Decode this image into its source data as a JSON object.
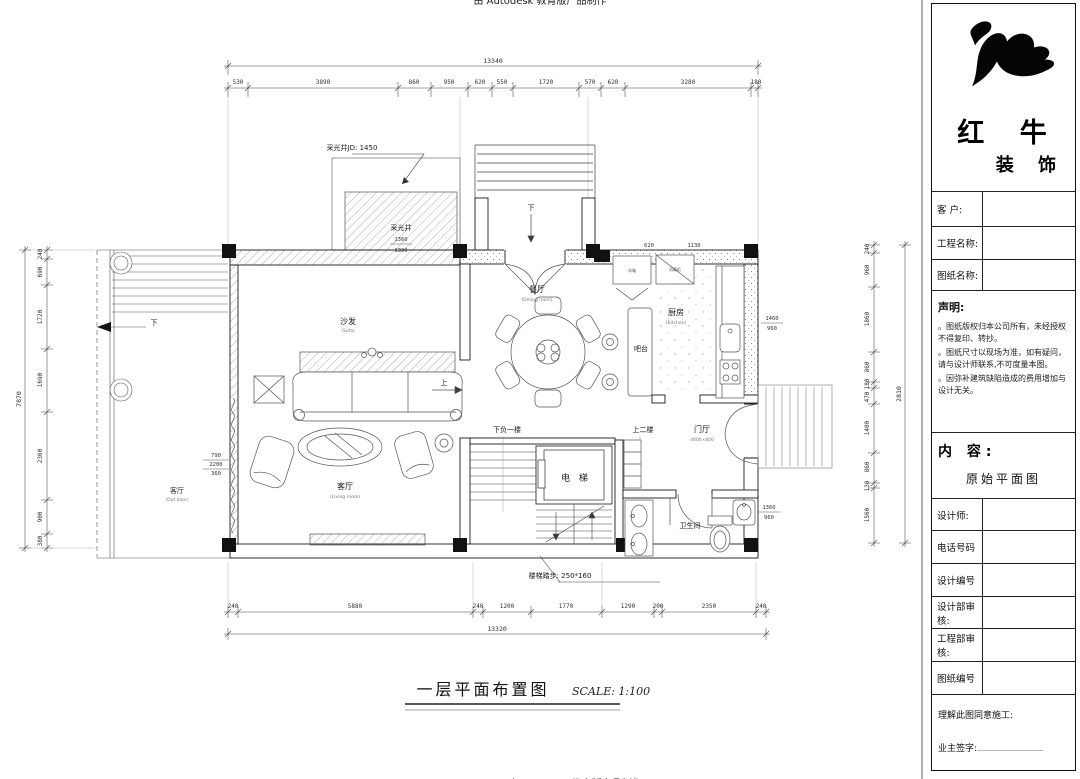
{
  "watermark": {
    "top": "由 Autodesk 教育版产品制作",
    "bottom": "由 Autodesk 教育版产品制作"
  },
  "title_block": {
    "brand_line1": "红 牛",
    "brand_line2": "装 饰",
    "row_customer": "客  户:",
    "row_project": "工程名称:",
    "row_drawing": "图纸名称:",
    "statement_title": "声明:",
    "statement_item1": "。图纸版权归本公司所有，未经授权不得复印、转抄。",
    "statement_item2": "。图纸尺寸以现场为准，如有疑问，请与设计师联系,不可度量本图。",
    "statement_item3": "。因弥补建筑缺陷造成的费用增加与设计无关。",
    "content_label": "内 容:",
    "content_value": "原始平面图",
    "row_designer": "设计师:",
    "row_phone": "电话号码",
    "row_design_no": "设计编号",
    "row_design_audit": "设计部审核:",
    "row_eng_audit": "工程部审核:",
    "row_drawing_no": "图纸编号",
    "footer_line1": "理解此图同意施工:",
    "footer_line2": "业主签字:"
  },
  "plan": {
    "title": "一层平面布置图",
    "scale": "SCALE: 1:100",
    "rooms": {
      "living": "客厅",
      "living_sub": "(Living room)",
      "outdoor": "客厅",
      "outdoor_sub": "(Out door)",
      "dining": "餐厅",
      "dining_sub": "(Dining room)",
      "kitchen": "厨房",
      "kitchen_sub": "(Kitchen)",
      "sofa": "沙发",
      "sofa_sub": "(Sofa)",
      "bar": "吧台",
      "foyer": "门厅",
      "foyer_sub": "4600×600",
      "bath": "卫生间",
      "elevator": "电 梯"
    },
    "nav": {
      "down_basement": "下负一楼",
      "up_second": "上二楼",
      "up": "上",
      "down_porch": "下",
      "down_left": "下"
    },
    "annotations": {
      "skylight_leader": "采光井JD: 1450",
      "skylight": "采光井",
      "skylight_d1": "1360",
      "skylight_d2": "1300",
      "stair_note": "楼梯踏步: 250*160",
      "stack_left": [
        "790",
        "2200",
        "360"
      ],
      "stack_right1": [
        "1460",
        "960"
      ],
      "stack_right2": [
        "1360",
        "960"
      ],
      "kitchen_d1": "620",
      "kitchen_d2": "1130",
      "fridge": "冰箱",
      "sterilizer": "消毒柜"
    },
    "dims": {
      "top": {
        "total": "13340",
        "segments": [
          "530",
          "3890",
          "860",
          "950",
          "620",
          "550",
          "1720",
          "570",
          "620",
          "3280",
          "180"
        ]
      },
      "bottom": {
        "total": "13320",
        "segments": [
          "240",
          "5880",
          "240",
          "1200",
          "1770",
          "1290",
          "200",
          "2350",
          "240"
        ]
      },
      "left": {
        "total": "7870",
        "segments": [
          "240",
          "690",
          "1720",
          "1690",
          "2360",
          "900",
          "380"
        ]
      },
      "right": {
        "total": "2810",
        "segments": [
          "240",
          "960",
          "1860",
          "860",
          "180",
          "470",
          "1400",
          "860",
          "130",
          "1560"
        ]
      }
    }
  }
}
